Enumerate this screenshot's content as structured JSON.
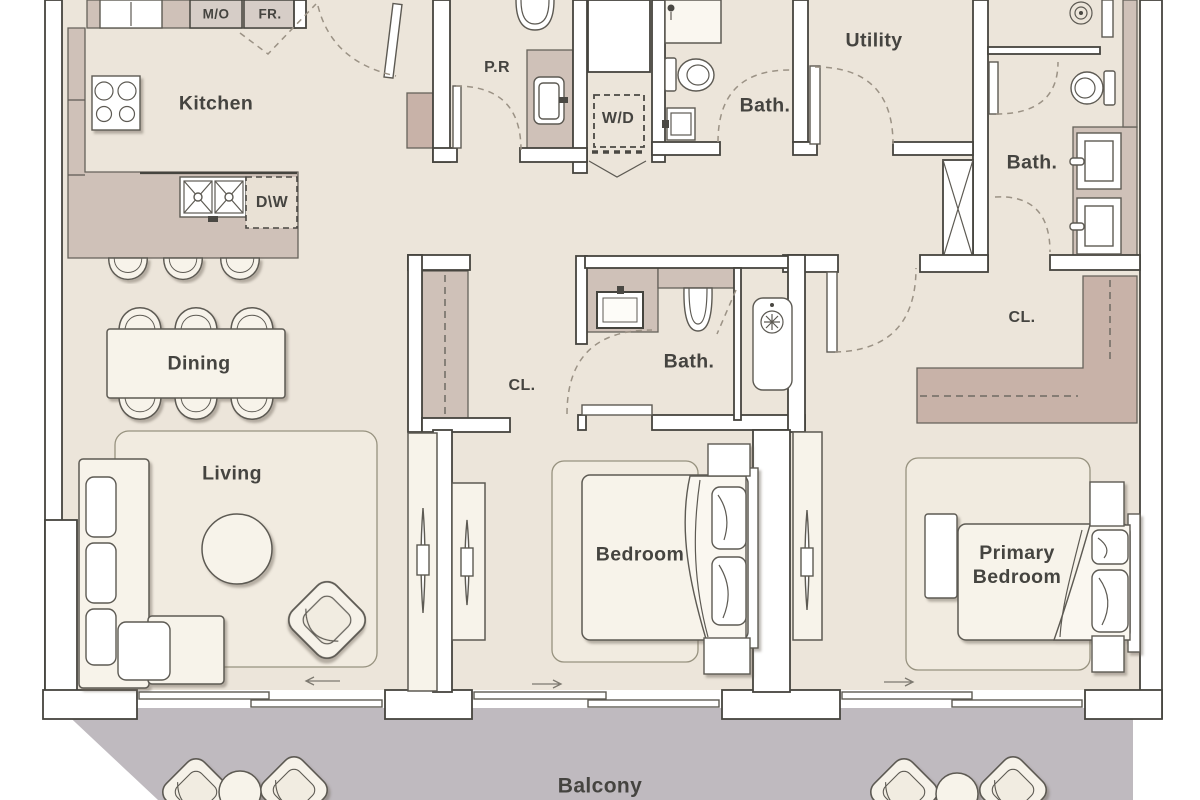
{
  "plan": {
    "labels": {
      "kitchen": "Kitchen",
      "dining": "Dining",
      "living": "Living",
      "bedroom": "Bedroom",
      "primary_line1": "Primary",
      "primary_line2": "Bedroom",
      "balcony": "Balcony",
      "utility": "Utility",
      "bath": "Bath.",
      "powder": "P.R",
      "closet": "CL.",
      "washer_dryer": "W/D",
      "dishwasher": "D\\W",
      "microwave": "M/O",
      "fridge": "FR."
    },
    "colors": {
      "floor": "#ece5da",
      "balcony": "#bfbabf",
      "cabinetry": "#cfc1b8",
      "wardrobe_accent": "#c8b2a8",
      "wall_outline": "#45443e",
      "furniture": "#f7f3ea",
      "text": "#454440"
    }
  }
}
